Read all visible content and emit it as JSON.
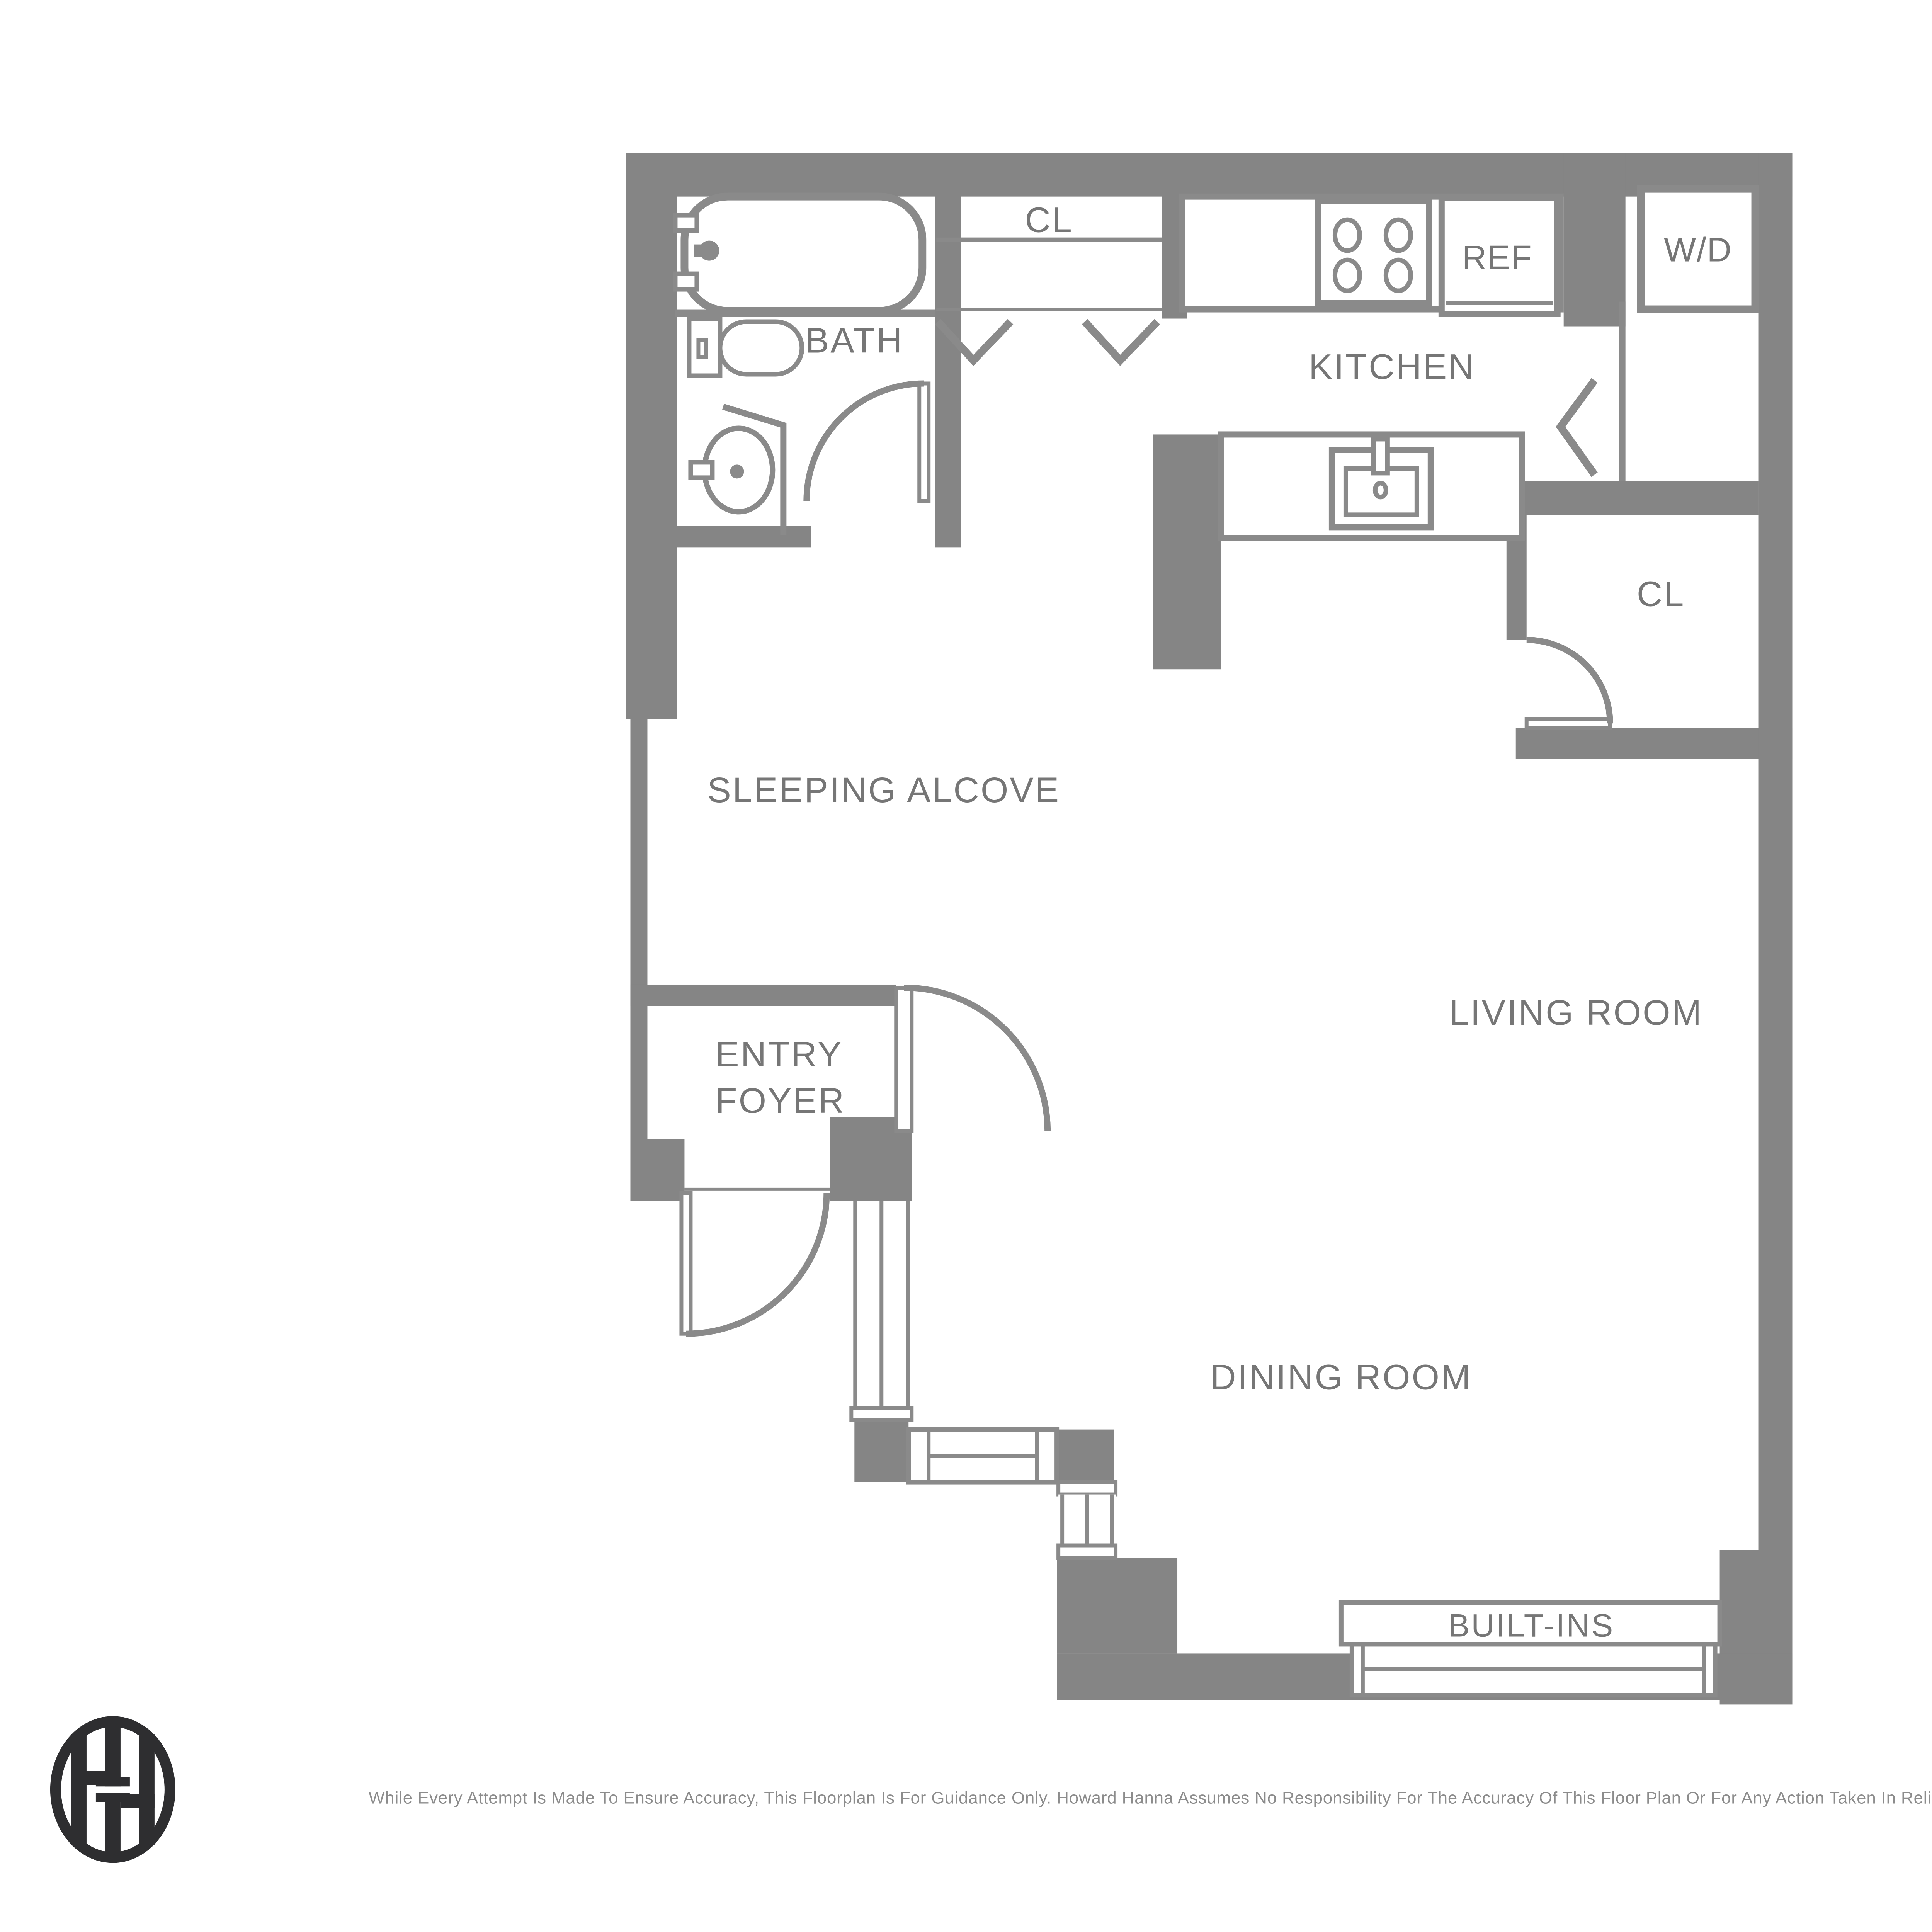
{
  "floorplan": {
    "rooms": {
      "bath": "BATH",
      "closet_top": "CL",
      "kitchen": "KITCHEN",
      "ref": "REF",
      "washer_dryer": "W/D",
      "closet_right": "CL",
      "sleeping_alcove": "SLEEPING ALCOVE",
      "living_room": "LIVING ROOM",
      "entry_foyer_line1": "ENTRY",
      "entry_foyer_line2": "FOYER",
      "dining_room": "DINING ROOM",
      "built_ins": "BUILT-INS"
    },
    "colors": {
      "wall": "#858585",
      "fixture_line": "#8a8a8a",
      "label_text": "#767676",
      "logo_ink": "#2e2e30",
      "background": "#ffffff"
    },
    "footer": {
      "disclaimer": "While Every Attempt Is Made To Ensure Accuracy, This Floorplan Is For Guidance Only. Howard Hanna Assumes No Responsibility For The Accuracy Of This Floor Plan Or For Any Action Taken In Reliance Thereon."
    },
    "logo": "howard-hanna-monogram"
  }
}
